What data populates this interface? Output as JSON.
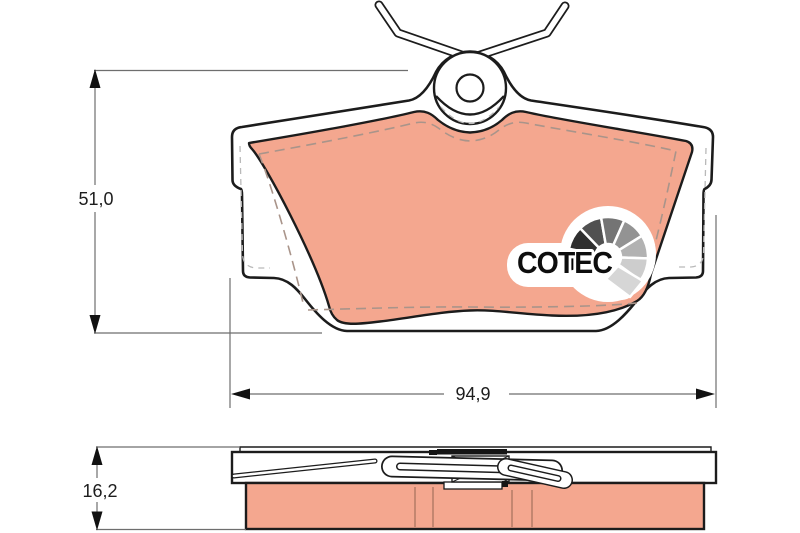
{
  "drawing": {
    "type": "brake-pad-technical-drawing",
    "views": {
      "front": "front view with retaining spring and guide boss",
      "side": "side view showing pad thickness"
    },
    "dimensions": {
      "height": {
        "label": "51,0"
      },
      "width": {
        "label": "94,9"
      },
      "thickness": {
        "label": "16,2"
      }
    },
    "logo": {
      "text": "COTEC"
    },
    "colors": {
      "pad_material": "#F4A78F",
      "outline": "#1C1C1C",
      "dimension_lines": "#6E6E6E",
      "chamfer_dash": "#A9948A",
      "hidden_dash": "#B9B9B9",
      "logo_text": "#0D0D0D",
      "fan_segments": [
        "#000000",
        "#2F2F2F",
        "#515151",
        "#747474",
        "#939393",
        "#B2B2B2",
        "#CDCDCD",
        "#D6D6D6"
      ]
    }
  }
}
